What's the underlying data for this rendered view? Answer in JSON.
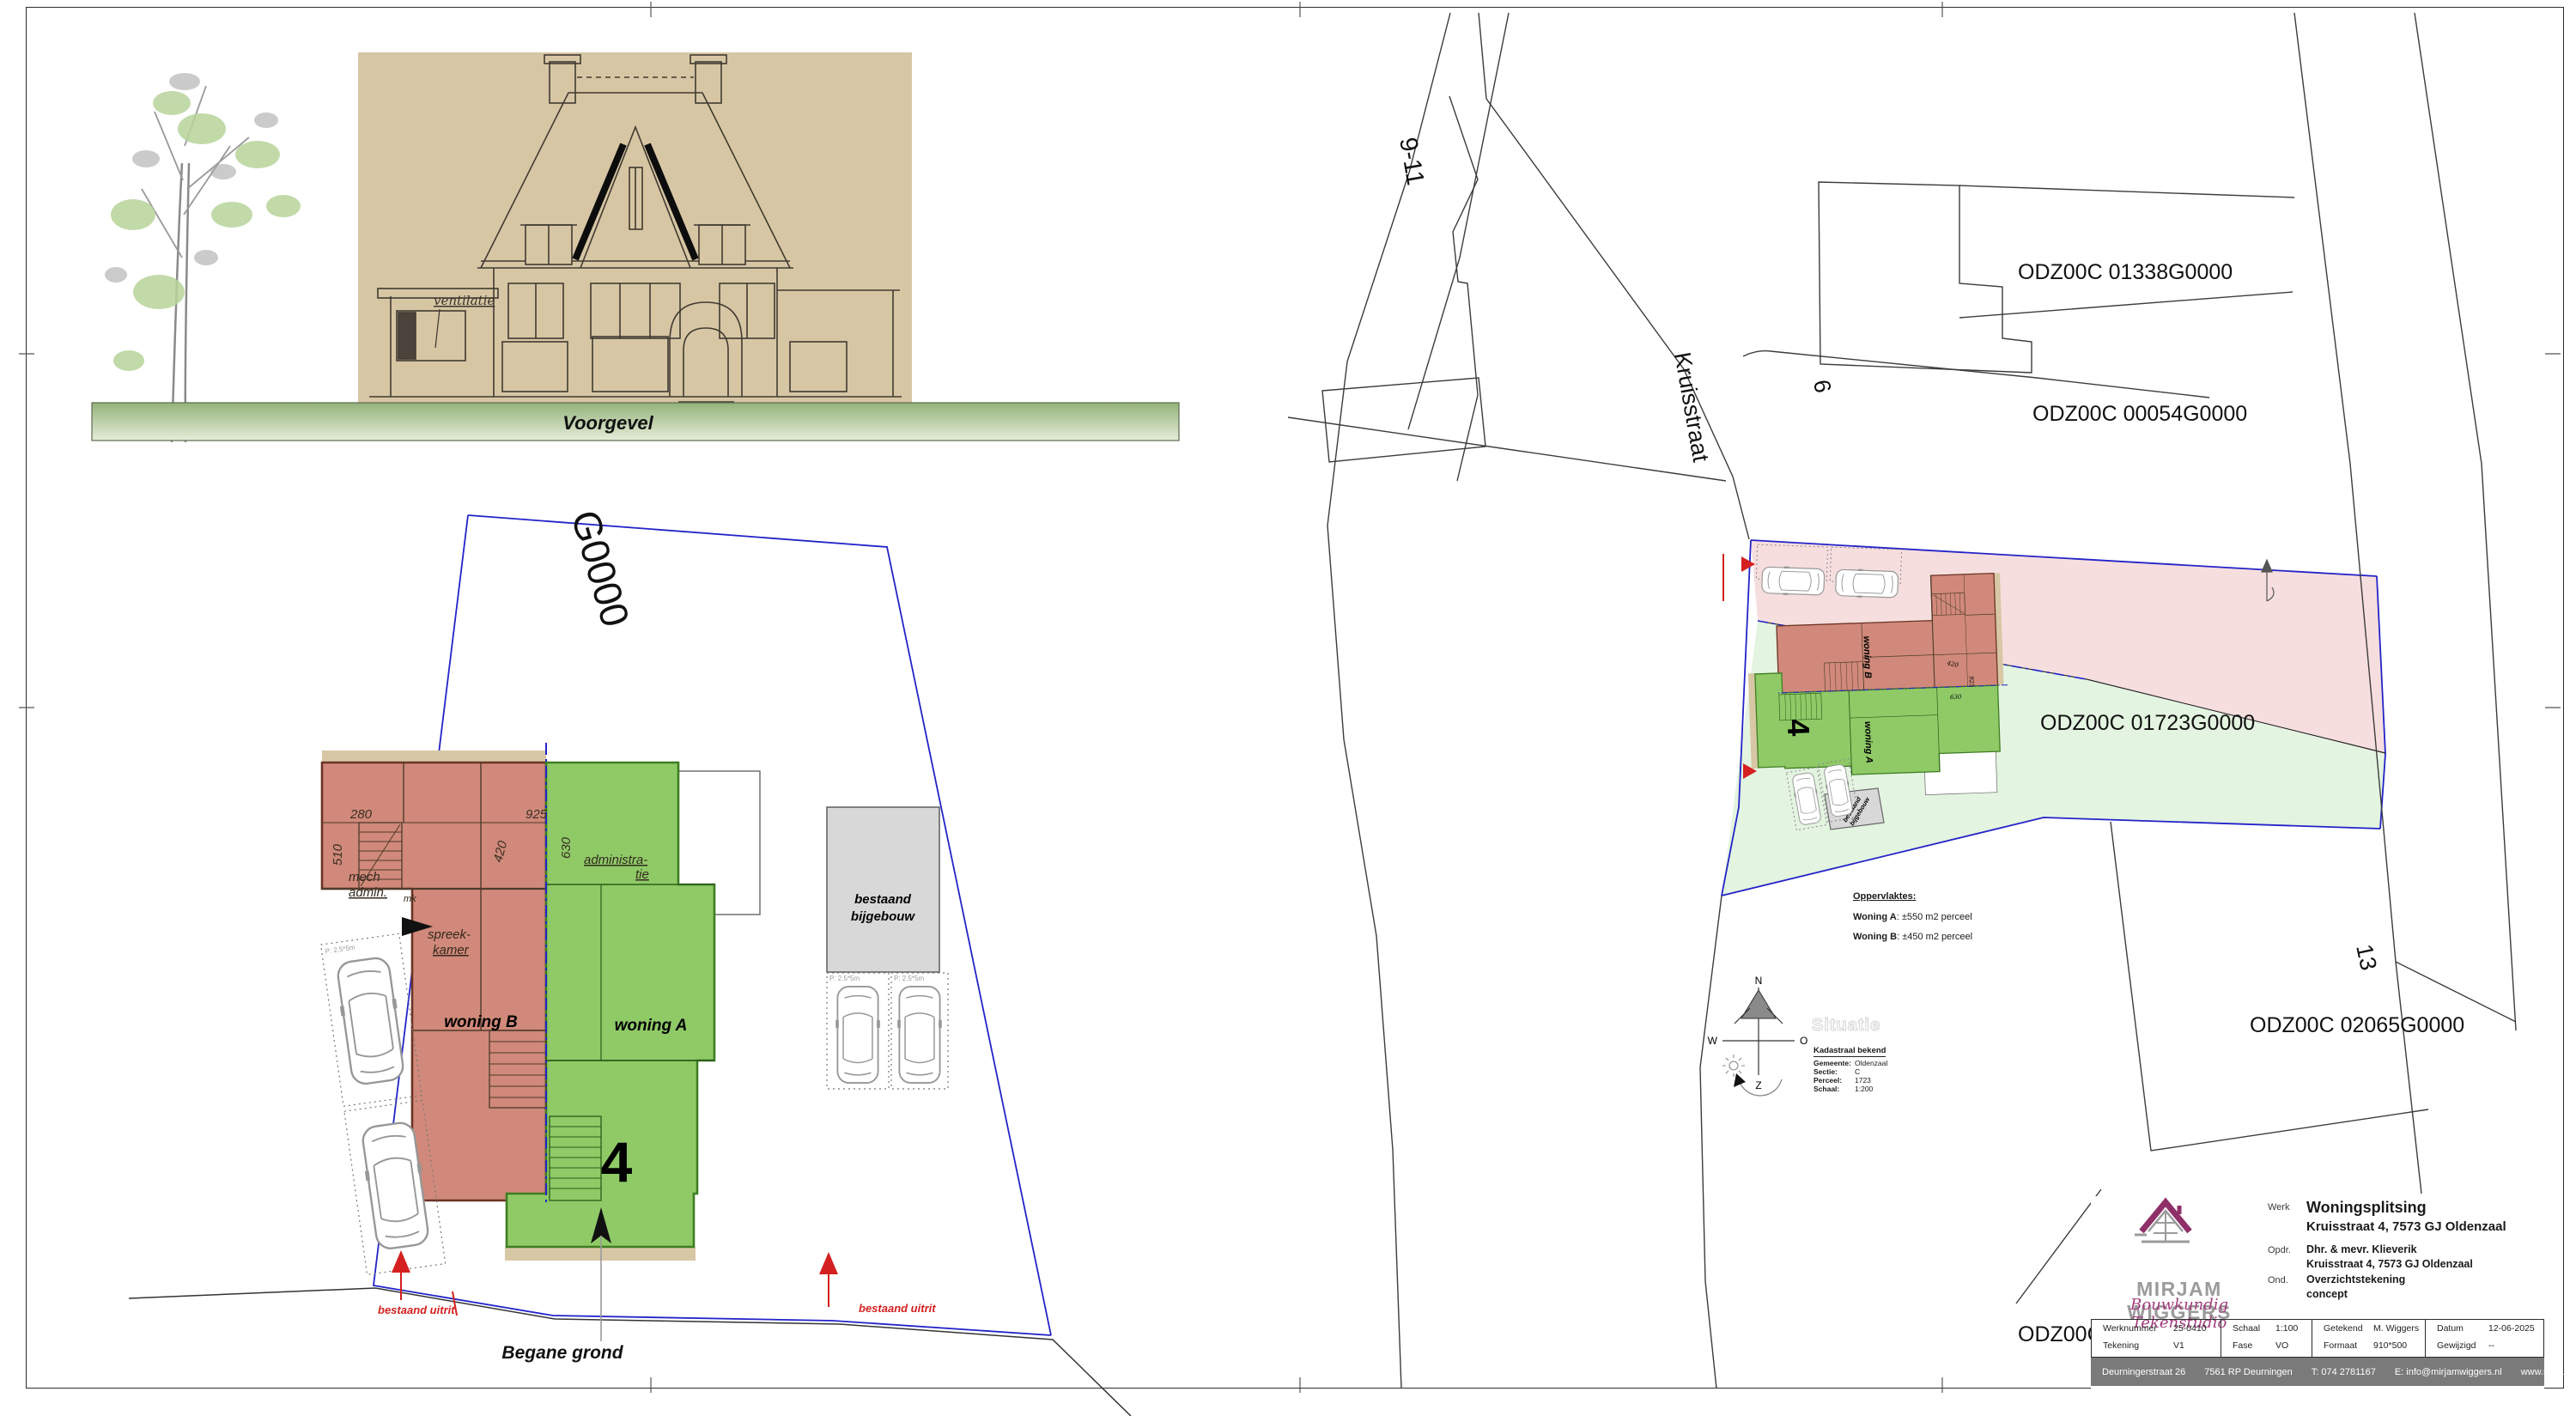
{
  "colors": {
    "pink_parcel": "#f6dede",
    "green_parcel": "#e3f4e0",
    "red_unit": "#d0897a",
    "green_unit": "#8fca67",
    "paper_tan": "#d8c7a5",
    "boundary_blue": "#2323c8",
    "marker_red": "#d42020",
    "footer_gray": "#7a7a7a",
    "logo_purple": "#8f3069",
    "logo_gray": "#9b9b9b"
  },
  "facade": {
    "title": "Voorgevel",
    "annotation": "ventilatie"
  },
  "floor_plan": {
    "title": "Begane grond",
    "parcel_partial": "G0000",
    "house_number": "4",
    "unit_a": "woning A",
    "unit_b": "woning B",
    "outbuilding_line1": "bestaand",
    "outbuilding_line2": "bijgebouw",
    "exit_left": "bestaand uitrit",
    "exit_right": "bestaand uitrit",
    "rooms": {
      "mech_1": "mech",
      "mech_2": "admin.",
      "spreek_1": "spreek-",
      "spreek_2": "kamer",
      "admin_1": "administra-",
      "admin_2": "tie",
      "mk": "mk"
    },
    "dims": {
      "d280": "280",
      "d510": "510",
      "d925": "925",
      "d420": "420",
      "d630": "630"
    },
    "parking_size": "P: 2.5*5m"
  },
  "site_plan": {
    "ghost_title": "Situatie",
    "street": "Kruisstraat",
    "house_numbers": {
      "n9_11": "9-11",
      "n6": "6",
      "n13": "13"
    },
    "parcels": {
      "p01338": "ODZ00C 01338G0000",
      "p00054": "ODZ00C 00054G0000",
      "p01723": "ODZ00C 01723G0000",
      "p02065": "ODZ00C 02065G0000",
      "p_partial": "ODZ00C 0"
    },
    "unit_a": "woning A",
    "unit_b": "woning B",
    "house_number": "4",
    "outbuilding_line1": "bestaand",
    "outbuilding_line2": "bijgebouw",
    "areas": {
      "heading": "Oppervlaktes:",
      "a_label": "Woning A",
      "a_value": ": ±550 m2 perceel",
      "b_label": "Woning B",
      "b_value": ": ±450 m2 perceel"
    },
    "kadastraal": {
      "heading": "Kadastraal bekend",
      "rows": [
        {
          "label": "Gemeente:",
          "value": "Oldenzaal"
        },
        {
          "label": "Sectie:",
          "value": "C"
        },
        {
          "label": "Perceel:",
          "value": "1723"
        },
        {
          "label": "Schaal:",
          "value": "1:200"
        }
      ]
    },
    "compass": {
      "n": "N",
      "e": "O",
      "s": "Z",
      "w": "W"
    }
  },
  "title_block": {
    "logo_name": "MIRJAM WIGGERS",
    "logo_tagline": "Bouwkundig Tekenstudio",
    "werk_label": "Werk",
    "werk_line1": "Woningsplitsing",
    "werk_line2": "Kruisstraat 4, 7573 GJ Oldenzaal",
    "opdr_label": "Opdr.",
    "opdr_line1": "Dhr. & mevr. Klieverik",
    "opdr_line2": "Kruisstraat 4, 7573 GJ Oldenzaal",
    "ond_label": "Ond.",
    "ond_line1": "Overzichtstekening",
    "ond_line2": "concept",
    "table": {
      "werknummer_label": "Werknummer",
      "werknummer": "25-0410",
      "tekening_label": "Tekening",
      "tekening": "V1",
      "schaal_label": "Schaal",
      "schaal": "1:100",
      "fase_label": "Fase",
      "fase": "VO",
      "getekend_label": "Getekend",
      "getekend": "M. Wiggers",
      "formaat_label": "Formaat",
      "formaat": "910*500",
      "datum_label": "Datum",
      "datum": "12-06-2025",
      "gewijzigd_label": "Gewijzigd",
      "gewijzigd": "--"
    },
    "footer": {
      "address": "Deurningerstraat 26",
      "postal": "7561 RP Deurningen",
      "phone": "T: 074 2781167",
      "email": "E: info@mirjamwiggers.nl",
      "website": "www.mirjamwiggers.nl"
    }
  }
}
